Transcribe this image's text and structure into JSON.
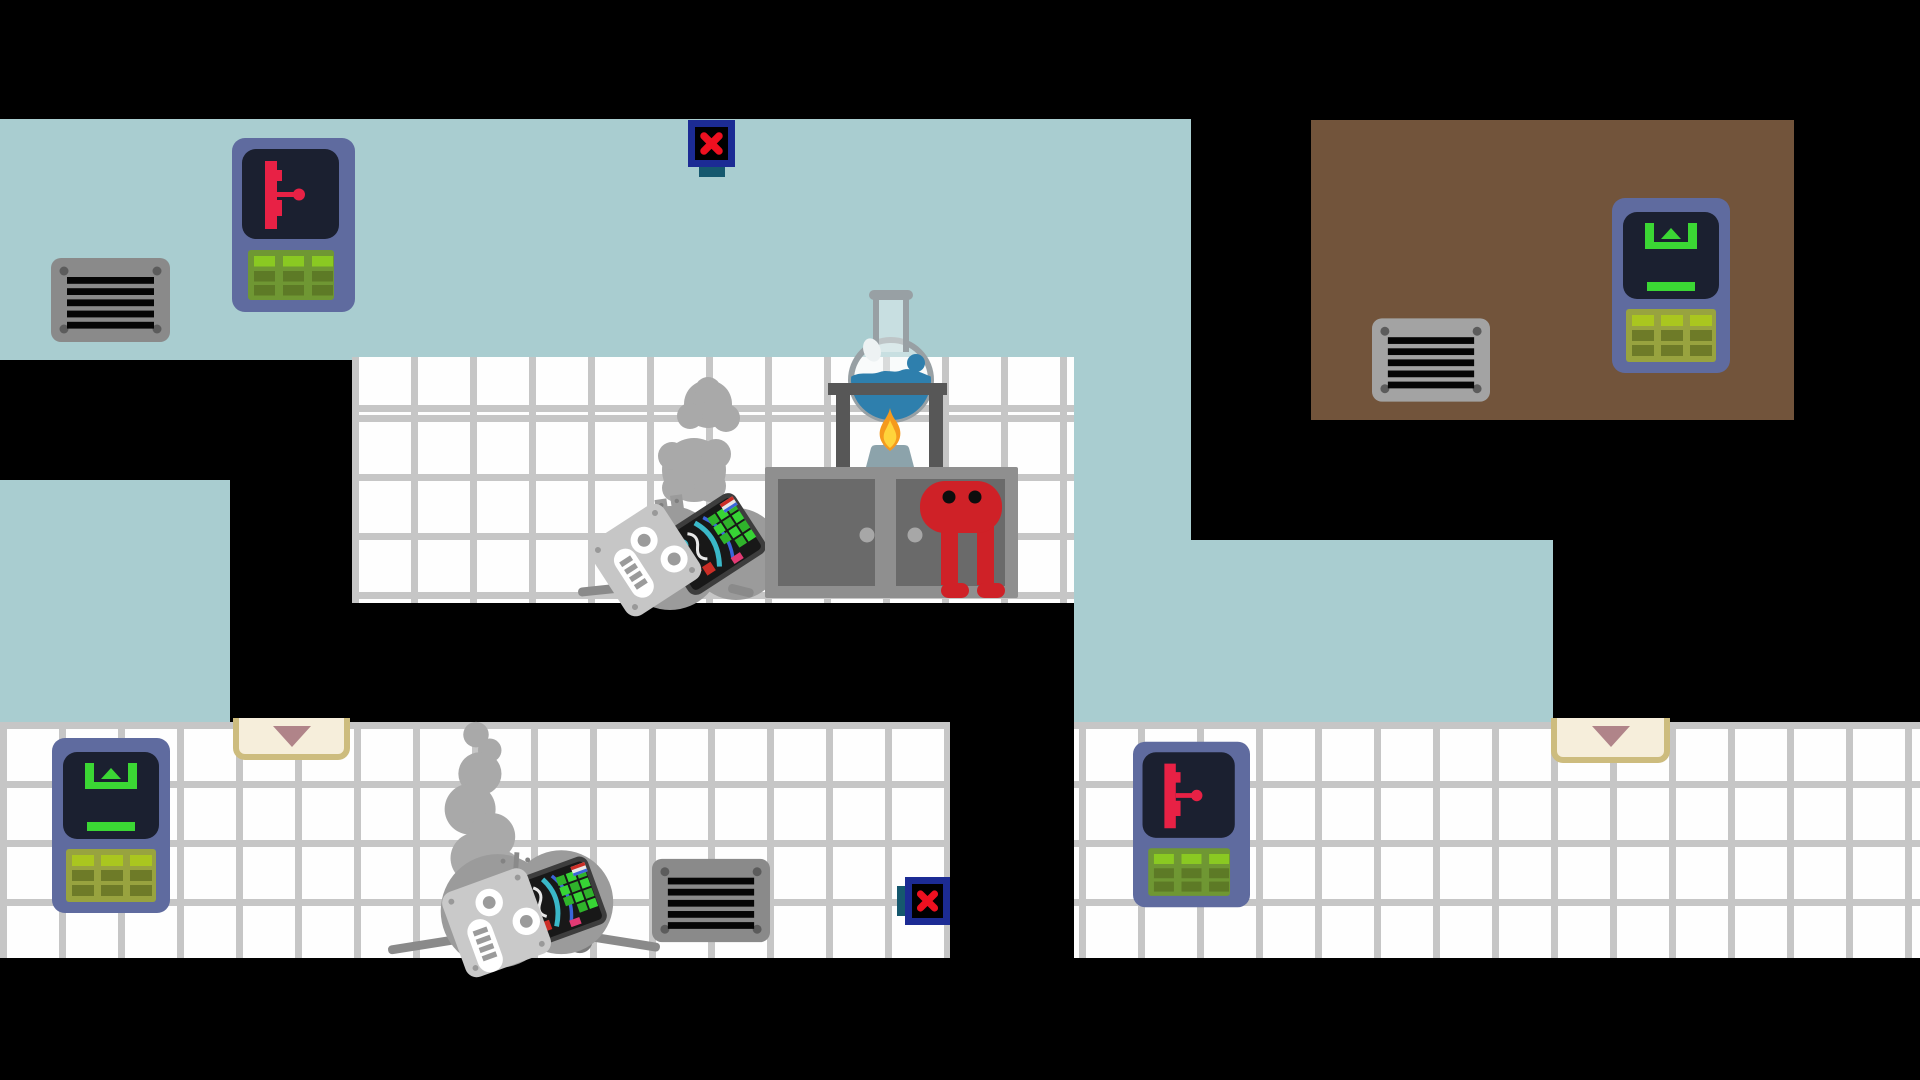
{
  "scene": {
    "viewport": {
      "w": 1920,
      "h": 1080
    },
    "background": "#000000",
    "palette": {
      "wall_blue": "#a9cdd0",
      "wall_brown": "#72543b",
      "tile": "#fefefe",
      "grout": "#c6c6c6",
      "panel_body": "#5f6b9f",
      "panel_screen": "#1b2030",
      "lever_red": "#e82145",
      "keypad_green": "#6f9733",
      "key_bright": "#8ac922",
      "key_dark": "#5d7a26",
      "elev_icon_green": "#3bd734",
      "elev_keypad": "#98a33f",
      "elev_key_bright": "#aac61f",
      "elev_key_dark": "#6e7b28",
      "vent_gray": "#8a8a8a",
      "vent_gray_light": "#a3a3a3",
      "vent_screw": "#5c5c5c",
      "vent_slat": "#050505",
      "xbox_frame": "#1c2b94",
      "xbox_inner": "#000000",
      "xbox_x": "#ee1020",
      "xbox_tab": "#15586e",
      "door_face": "#f6eedb",
      "door_trim": "#cdbc7e",
      "door_arrow": "#b08489",
      "cabinet_frame": "#8f8f8f",
      "cabinet_door": "#6a6a6a",
      "cabinet_handle": "#a7a7a7",
      "glass": "#98a0a4",
      "glass_fill": "rgba(244,248,248,0.42)",
      "glass_shine": "#edf2f3",
      "liquid_blue": "#2e7fad",
      "flame_outer": "#f59a1d",
      "flame_inner": "#ffd43b",
      "burner": "#8ca3ab",
      "stand": "#575757",
      "char_red": "#cf2127",
      "char_eye": "#0d0d0d",
      "robot_body": "#9b9b9b",
      "robot_head": "#c6c6c6",
      "robot_head2": "#c9c9c9",
      "robot_dark": "#7a7a7a",
      "robot_strut": "#8a8a8a",
      "robot_screw": "#999999",
      "smoke": "#a9a9a9",
      "circuit_bg": "#181818",
      "circuit_border": "#3d3d3d",
      "circuit_green": "#2fb32b",
      "circuit_green2": "#37d435",
      "circuit_red": "#cc2e26",
      "circuit_teal": "#3ab8c8",
      "circuit_blue": "#3a66d9",
      "circuit_pink": "#e23a74",
      "circuit_white": "#e8e8e8"
    },
    "rooms": [
      {
        "name": "wall-top-hall",
        "kind": "plain",
        "color": "wall_blue",
        "x": 0,
        "y": 119,
        "w": 1191,
        "h": 241
      },
      {
        "name": "wall-mid-shaft",
        "kind": "plain",
        "color": "wall_blue",
        "x": 1074,
        "y": 360,
        "w": 117,
        "h": 362
      },
      {
        "name": "wall-left-shaft",
        "kind": "plain",
        "color": "wall_blue",
        "x": 0,
        "y": 480,
        "w": 230,
        "h": 242
      },
      {
        "name": "wall-right-hall",
        "kind": "plain",
        "color": "wall_blue",
        "x": 1191,
        "y": 540,
        "w": 362,
        "h": 182
      },
      {
        "name": "wall-brown-room",
        "kind": "plain",
        "color": "wall_brown",
        "x": 1311,
        "y": 120,
        "w": 483,
        "h": 300
      },
      {
        "name": "room-lab-tiles",
        "kind": "tiles",
        "x": 352,
        "y": 357,
        "w": 722,
        "h": 246,
        "grid_x": 0,
        "grid_y": 58
      },
      {
        "name": "room-bottom-left-tiles",
        "kind": "tiles",
        "x": 0,
        "y": 722,
        "w": 950,
        "h": 236,
        "grid_x": 0,
        "grid_y": 0
      },
      {
        "name": "room-bottom-right-tiles",
        "kind": "tiles",
        "x": 1074,
        "y": 722,
        "w": 846,
        "h": 236,
        "grid_x": 5,
        "grid_y": 0
      }
    ],
    "props": [
      {
        "type": "vent",
        "name": "vent-top-left",
        "interactable": false,
        "x": 51,
        "y": 258,
        "w": 119,
        "h": 84,
        "shade": "vent_gray"
      },
      {
        "type": "lever_panel",
        "name": "lever-panel-top-left",
        "interactable": true,
        "x": 232,
        "y": 138,
        "w": 123,
        "h": 174
      },
      {
        "type": "x_sign",
        "name": "x-sign-top",
        "interactable": true,
        "x": 688,
        "y": 120,
        "w": 47,
        "h": 47,
        "tab": "bottom"
      },
      {
        "type": "vent",
        "name": "vent-brown-room",
        "interactable": false,
        "x": 1372,
        "y": 318,
        "w": 118,
        "h": 84,
        "shade": "vent_gray_light"
      },
      {
        "type": "lift_panel",
        "name": "lift-panel-brown-room",
        "interactable": true,
        "x": 1612,
        "y": 198,
        "w": 118,
        "h": 175
      },
      {
        "type": "robot_fallen",
        "name": "robot-fallen-smoking",
        "interactable": false,
        "x": 560,
        "y": 360,
        "w": 260,
        "h": 245
      },
      {
        "type": "cabinet",
        "name": "lab-cabinet",
        "interactable": false,
        "x": 765,
        "y": 467,
        "w": 253,
        "h": 131
      },
      {
        "type": "flask_rig",
        "name": "flask-burner-rig",
        "interactable": false,
        "x": 820,
        "y": 290,
        "w": 130,
        "h": 180
      },
      {
        "type": "player",
        "name": "player-character-red",
        "interactable": true,
        "x": 915,
        "y": 475,
        "w": 95,
        "h": 125
      },
      {
        "type": "door_sign",
        "name": "door-indicator-left",
        "interactable": true,
        "x": 233,
        "y": 718,
        "w": 117,
        "h": 42
      },
      {
        "type": "door_sign",
        "name": "door-indicator-right",
        "interactable": true,
        "x": 1551,
        "y": 718,
        "w": 119,
        "h": 45
      },
      {
        "type": "lift_panel",
        "name": "lift-panel-bottom-left",
        "interactable": true,
        "x": 52,
        "y": 738,
        "w": 118,
        "h": 175
      },
      {
        "type": "robot_standing",
        "name": "robot-standing-smoking",
        "interactable": false,
        "x": 375,
        "y": 715,
        "w": 300,
        "h": 245
      },
      {
        "type": "vent",
        "name": "vent-bottom-left",
        "interactable": false,
        "x": 652,
        "y": 858,
        "w": 118,
        "h": 85,
        "shade": "vent_gray"
      },
      {
        "type": "x_sign",
        "name": "x-sign-bottom",
        "interactable": true,
        "x": 905,
        "y": 877,
        "w": 45,
        "h": 48,
        "tab": "left"
      },
      {
        "type": "lever_panel",
        "name": "lever-panel-bottom-right",
        "interactable": true,
        "x": 1133,
        "y": 737,
        "w": 117,
        "h": 175
      }
    ]
  }
}
